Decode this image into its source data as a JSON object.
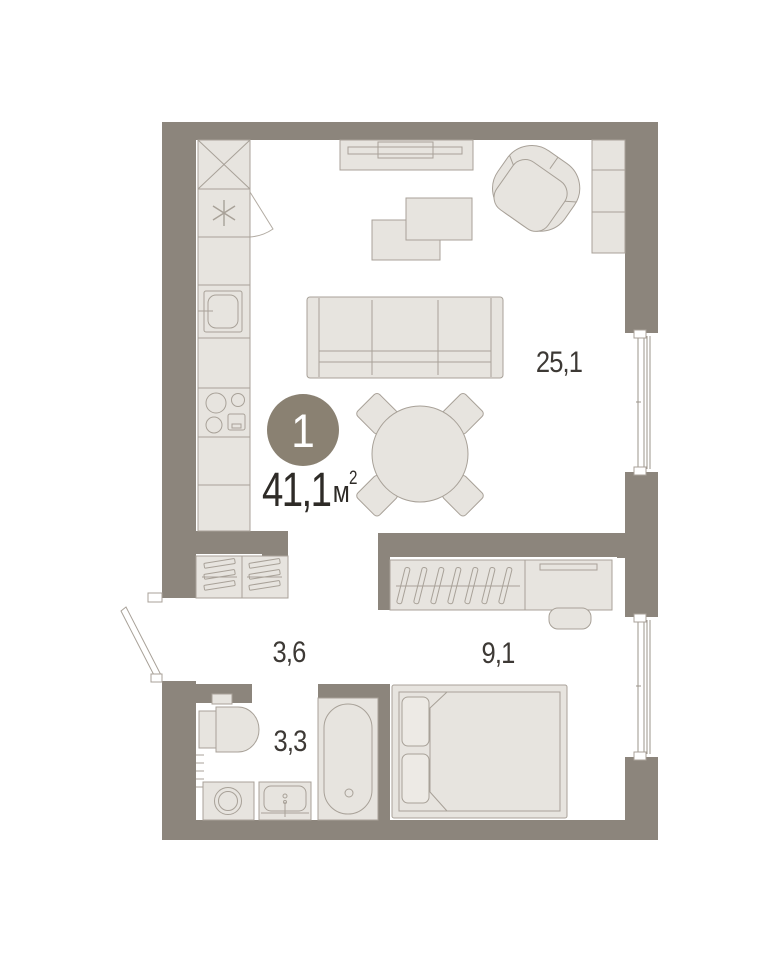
{
  "plan": {
    "unit_badge": {
      "unit_number": "1",
      "area_value": "41,1",
      "area_unit": "м",
      "area_unit_exponent": "2"
    },
    "rooms": [
      {
        "name": "living-room-kitchen",
        "area_label": "25,1"
      },
      {
        "name": "hallway",
        "area_label": "3,6"
      },
      {
        "name": "bedroom",
        "area_label": "9,1"
      },
      {
        "name": "bathroom",
        "area_label": "3,3"
      }
    ],
    "colors": {
      "wall": "#8c857c",
      "furniture_fill": "#e7e4df",
      "furniture_stroke": "#a8a198",
      "floor": "#ffffff",
      "badge_fill": "#8a8172",
      "label_text": "#3d3935",
      "area_text": "#2e2b27"
    }
  }
}
